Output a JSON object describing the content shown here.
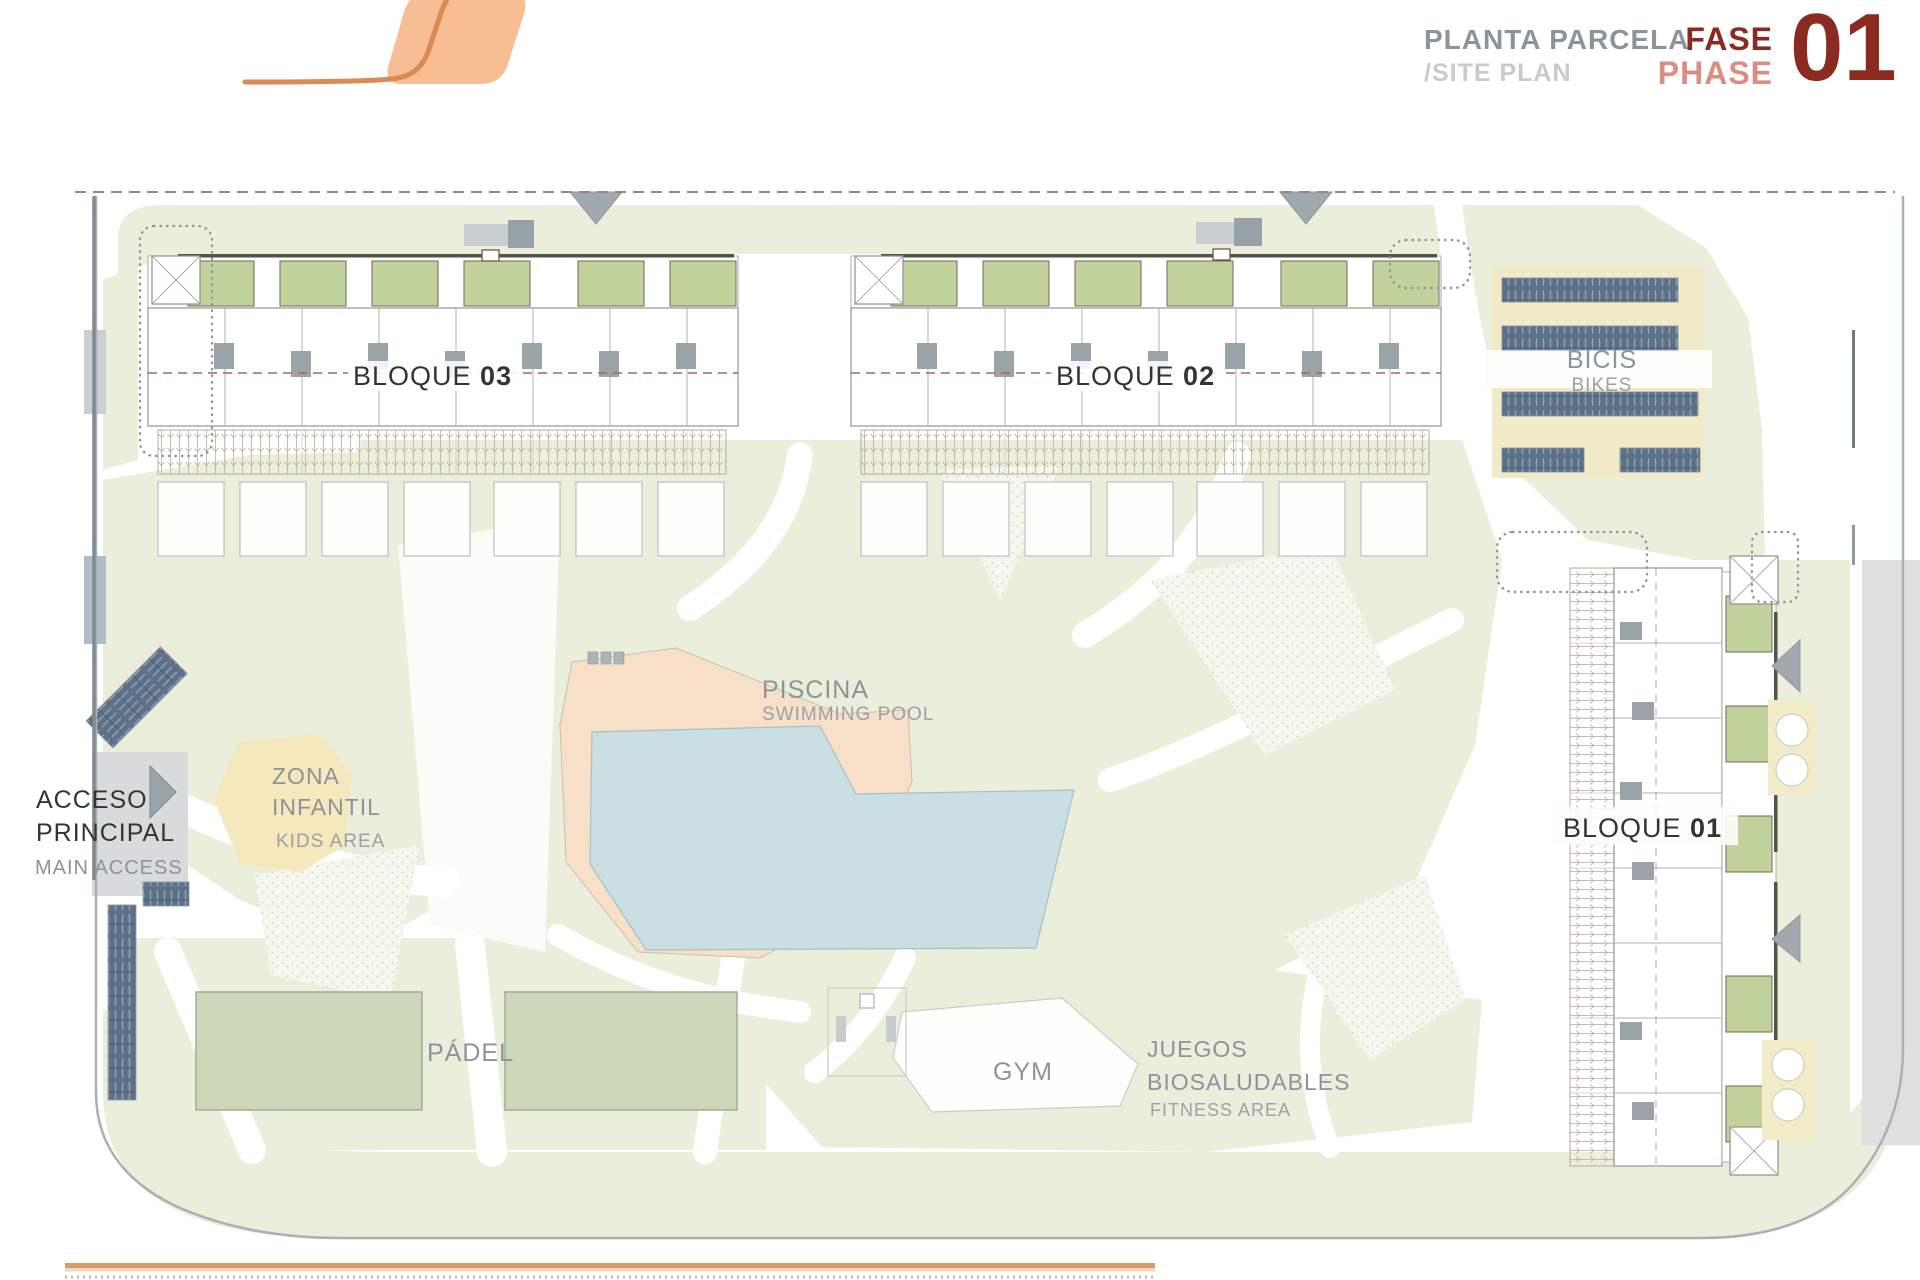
{
  "header": {
    "title_es": "PLANTA PARCELA",
    "title_en": "/SITE PLAN",
    "phase_es": "FASE",
    "phase_en": "PHASE",
    "phase_number": "01"
  },
  "plan": {
    "blocks": {
      "b03": {
        "name": "BLOQUE ",
        "number": "03"
      },
      "b02": {
        "name": "BLOQUE ",
        "number": "02"
      },
      "b01": {
        "name": "BLOQUE ",
        "number": "01"
      }
    },
    "areas": {
      "bikes": {
        "es": "BICIS",
        "en": "BIKES"
      },
      "pool": {
        "es": "PISCINA",
        "en": "SWIMMING POOL"
      },
      "kids": {
        "es_line1": "ZONA",
        "es_line2": "INFANTIL",
        "en": "KIDS AREA"
      },
      "access": {
        "es_line1": "ACCESO",
        "es_line2": "PRINCIPAL",
        "en": "MAIN ACCESS"
      },
      "padel": {
        "es": "PÁDEL"
      },
      "gym": {
        "es": "GYM"
      },
      "fitness": {
        "es_line1": "JUEGOS",
        "es_line2": "BIOSALUDABLES",
        "en": "FITNESS AREA"
      }
    },
    "colors": {
      "accent_orange": "#DD8A52",
      "logo_fill": "#F8BE93",
      "phase_dark": "#8B2A20",
      "phase_light": "#D98E82",
      "lawn_green": "#EAEEDB",
      "pool_water": "#C9DFE3",
      "pool_deck": "#F7DFC8",
      "court_green": "#CBD7B6",
      "terrace_green": "#C1D29D",
      "bike_rack_blue": "#5E7187",
      "bike_area_cream": "#F2EBC8",
      "kids_yellow": "#F6E8BD"
    }
  }
}
